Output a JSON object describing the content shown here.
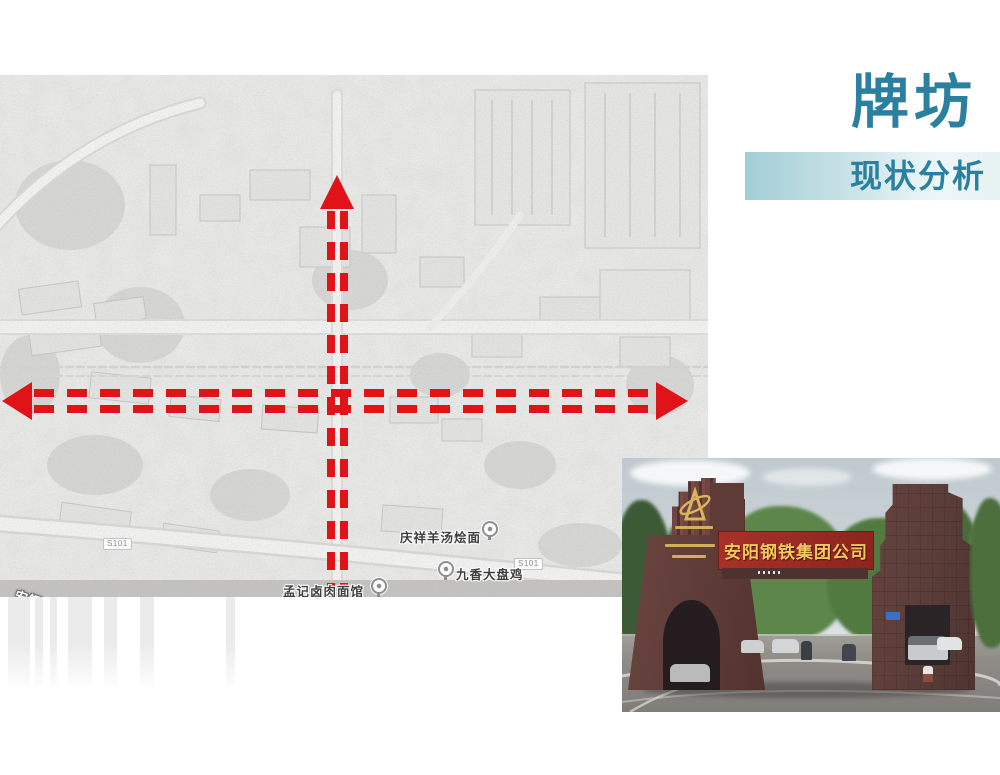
{
  "slide": {
    "title": "牌坊",
    "subtitle": "现状分析",
    "accent_color": "#2b80a0",
    "bar_gradient": [
      "#a3ced6",
      "#eef7f7"
    ]
  },
  "map": {
    "kind": "grayscale satellite analysis map",
    "axis_arrow_color": "#e01418",
    "road_label": "安钢大道",
    "route_badges": [
      "S101",
      "S101"
    ],
    "poi_labels": [
      "庆祥羊汤烩面",
      "九香大盘鸡",
      "孟记卤肉面馆"
    ]
  },
  "photo": {
    "kind": "factory gate photograph",
    "sign_text": "安阳钢铁集团公司",
    "sign_bg_color": "#9b2b23",
    "sign_text_color": "#f2c95c"
  }
}
